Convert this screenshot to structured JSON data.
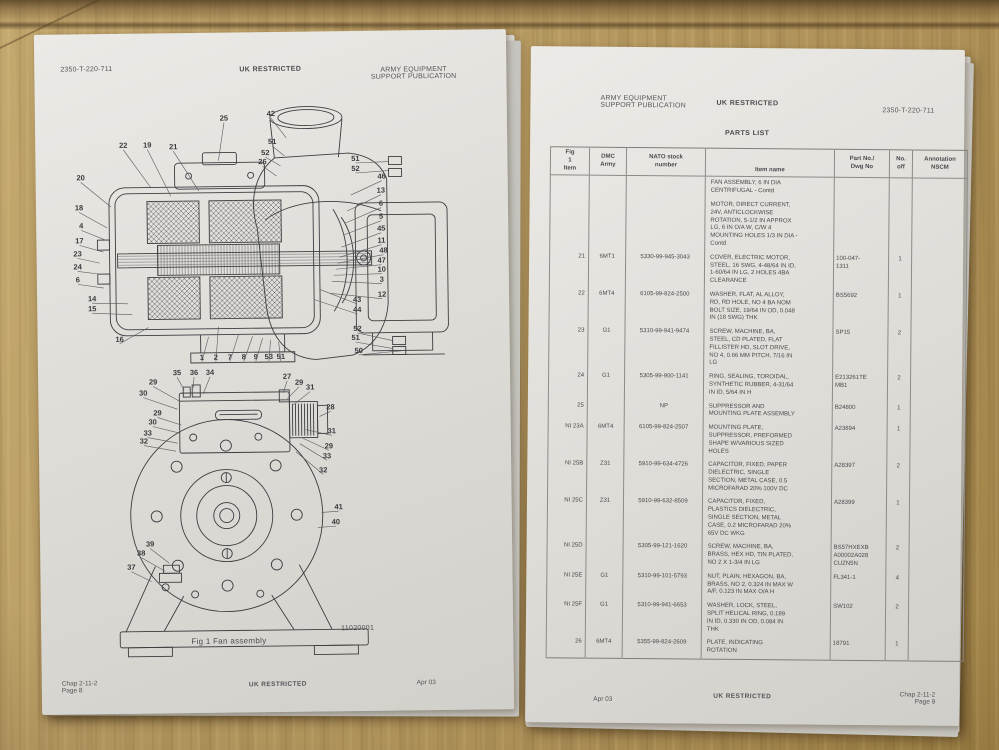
{
  "photo": {
    "wood_color": "#b89c63",
    "paper_color": "#e3e1dc"
  },
  "left_page": {
    "header": {
      "doc_number": "2350-T-220-711",
      "classification": "UK RESTRICTED",
      "publication": "ARMY EQUIPMENT\nSUPPORT PUBLICATION"
    },
    "figure": {
      "caption": "Fig 1  Fan assembly",
      "ref_number": "11020001",
      "top_view_callouts": [
        {
          "label": "22",
          "tx": 73,
          "ty": 46,
          "lx": 100,
          "ly": 86
        },
        {
          "label": "19",
          "tx": 97,
          "ty": 46,
          "lx": 120,
          "ly": 95
        },
        {
          "label": "21",
          "tx": 123,
          "ty": 48,
          "lx": 148,
          "ly": 90
        },
        {
          "label": "20",
          "tx": 30,
          "ty": 78,
          "lx": 60,
          "ly": 105
        },
        {
          "label": "18",
          "tx": 28,
          "ty": 108,
          "lx": 56,
          "ly": 126
        },
        {
          "label": "4",
          "tx": 30,
          "ty": 126,
          "lx": 54,
          "ly": 138
        },
        {
          "label": "17",
          "tx": 28,
          "ty": 141,
          "lx": 52,
          "ly": 150
        },
        {
          "label": "23",
          "tx": 26,
          "ty": 154,
          "lx": 48,
          "ly": 161
        },
        {
          "label": "24",
          "tx": 26,
          "ty": 167,
          "lx": 48,
          "ly": 172
        },
        {
          "label": "6",
          "tx": 26,
          "ty": 180,
          "lx": 52,
          "ly": 186
        },
        {
          "label": "14",
          "tx": 40,
          "ty": 199,
          "lx": 76,
          "ly": 202
        },
        {
          "label": "15",
          "tx": 40,
          "ty": 209,
          "lx": 80,
          "ly": 213
        },
        {
          "label": "16",
          "tx": 67,
          "ty": 240,
          "lx": 96,
          "ly": 226
        },
        {
          "label": "25",
          "tx": 174,
          "ty": 20,
          "lx": 168,
          "ly": 60
        },
        {
          "label": "42",
          "tx": 221,
          "ty": 16,
          "lx": 236,
          "ly": 38
        },
        {
          "label": "51",
          "tx": 222,
          "ty": 44,
          "lx": 234,
          "ly": 56
        },
        {
          "label": "52",
          "tx": 215,
          "ty": 55,
          "lx": 230,
          "ly": 66
        },
        {
          "label": "26",
          "tx": 212,
          "ty": 64,
          "lx": 226,
          "ly": 76
        },
        {
          "label": "51",
          "tx": 305,
          "ty": 62,
          "lx": 338,
          "ly": 63
        },
        {
          "label": "52",
          "tx": 305,
          "ty": 72,
          "lx": 338,
          "ly": 72
        },
        {
          "label": "46",
          "tx": 331,
          "ty": 80,
          "lx": 300,
          "ly": 96
        },
        {
          "label": "13",
          "tx": 330,
          "ty": 94,
          "lx": 296,
          "ly": 112
        },
        {
          "label": "6",
          "tx": 330,
          "ty": 107,
          "lx": 294,
          "ly": 124
        },
        {
          "label": "5",
          "tx": 330,
          "ty": 120,
          "lx": 292,
          "ly": 136
        },
        {
          "label": "45",
          "tx": 330,
          "ty": 132,
          "lx": 290,
          "ly": 148
        },
        {
          "label": "11",
          "tx": 330,
          "ty": 144,
          "lx": 288,
          "ly": 158
        },
        {
          "label": "48",
          "tx": 332,
          "ty": 154,
          "lx": 286,
          "ly": 164
        },
        {
          "label": "47",
          "tx": 330,
          "ty": 164,
          "lx": 284,
          "ly": 170
        },
        {
          "label": "10",
          "tx": 330,
          "ty": 173,
          "lx": 282,
          "ly": 176
        },
        {
          "label": "3",
          "tx": 330,
          "ty": 183,
          "lx": 280,
          "ly": 182
        },
        {
          "label": "12",
          "tx": 330,
          "ty": 198,
          "lx": 278,
          "ly": 194
        },
        {
          "label": "43",
          "tx": 305,
          "ty": 203,
          "lx": 268,
          "ly": 190
        },
        {
          "label": "44",
          "tx": 305,
          "ty": 213,
          "lx": 262,
          "ly": 200
        },
        {
          "label": "52",
          "tx": 305,
          "ty": 232,
          "lx": 340,
          "ly": 242
        },
        {
          "label": "51",
          "tx": 303,
          "ty": 241,
          "lx": 340,
          "ly": 250
        },
        {
          "label": "50",
          "tx": 306,
          "ty": 254,
          "lx": 352,
          "ly": 252
        },
        {
          "label": "1",
          "tx": 149,
          "ty": 259,
          "lx": 156,
          "ly": 236
        },
        {
          "label": "2",
          "tx": 163,
          "ty": 259,
          "lx": 166,
          "ly": 226
        },
        {
          "label": "7",
          "tx": 177,
          "ty": 259,
          "lx": 186,
          "ly": 234
        },
        {
          "label": "8",
          "tx": 191,
          "ty": 259,
          "lx": 200,
          "ly": 236
        },
        {
          "label": "9",
          "tx": 203,
          "ty": 259,
          "lx": 210,
          "ly": 238
        },
        {
          "label": "53",
          "tx": 216,
          "ty": 259,
          "lx": 218,
          "ly": 240
        },
        {
          "label": "51",
          "tx": 228,
          "ty": 259,
          "lx": 226,
          "ly": 242
        }
      ],
      "bottom_view_callouts": [
        {
          "label": "35",
          "tx": 124,
          "ty": 274,
          "lx": 131,
          "ly": 289
        },
        {
          "label": "36",
          "tx": 141,
          "ty": 274,
          "lx": 140,
          "ly": 287
        },
        {
          "label": "34",
          "tx": 157,
          "ty": 274,
          "lx": 150,
          "ly": 293
        },
        {
          "label": "27",
          "tx": 234,
          "ty": 279,
          "lx": 230,
          "ly": 293
        },
        {
          "label": "29",
          "tx": 246,
          "ty": 285,
          "lx": 234,
          "ly": 299
        },
        {
          "label": "31",
          "tx": 257,
          "ty": 290,
          "lx": 240,
          "ly": 305
        },
        {
          "label": "29",
          "tx": 100,
          "ty": 283,
          "lx": 126,
          "ly": 300
        },
        {
          "label": "30",
          "tx": 90,
          "ty": 294,
          "lx": 124,
          "ly": 308
        },
        {
          "label": "29",
          "tx": 104,
          "ty": 314,
          "lx": 128,
          "ly": 324
        },
        {
          "label": "30",
          "tx": 99,
          "ty": 323,
          "lx": 126,
          "ly": 332
        },
        {
          "label": "33",
          "tx": 94,
          "ty": 334,
          "lx": 124,
          "ly": 342
        },
        {
          "label": "32",
          "tx": 90,
          "ty": 342,
          "lx": 122,
          "ly": 350
        },
        {
          "label": "28",
          "tx": 277,
          "ty": 310,
          "lx": 266,
          "ly": 317
        },
        {
          "label": "31",
          "tx": 278,
          "ty": 334,
          "lx": 252,
          "ly": 330
        },
        {
          "label": "29",
          "tx": 275,
          "ty": 349,
          "lx": 248,
          "ly": 338
        },
        {
          "label": "33",
          "tx": 273,
          "ty": 359,
          "lx": 246,
          "ly": 344
        },
        {
          "label": "32",
          "tx": 269,
          "ty": 373,
          "lx": 242,
          "ly": 352
        },
        {
          "label": "41",
          "tx": 284,
          "ty": 410,
          "lx": 267,
          "ly": 413
        },
        {
          "label": "40",
          "tx": 281,
          "ty": 425,
          "lx": 263,
          "ly": 428
        },
        {
          "label": "39",
          "tx": 95,
          "ty": 445,
          "lx": 114,
          "ly": 462
        },
        {
          "label": "38",
          "tx": 86,
          "ty": 454,
          "lx": 110,
          "ly": 470
        },
        {
          "label": "37",
          "tx": 76,
          "ty": 468,
          "lx": 96,
          "ly": 480
        }
      ]
    },
    "footer": {
      "chapter": "Chap 2-11-2",
      "page": "Page 8",
      "classification": "UK RESTRICTED",
      "date": "Apr 03"
    }
  },
  "right_page": {
    "header": {
      "publication": "ARMY EQUIPMENT\nSUPPORT PUBLICATION",
      "classification": "UK RESTRICTED",
      "doc_number": "2350-T-220-711"
    },
    "title": "PARTS LIST",
    "table": {
      "headers": [
        "Fig\n1\nItem",
        "DMC\nArmy",
        "NATO stock\nnumber",
        "Item name",
        "Part No./\nDwg No",
        "No.\noff",
        "Annotation\nNSCM"
      ],
      "rows": [
        {
          "item": "",
          "dmc": "",
          "nato": "",
          "name": "FAN ASSEMBLY, 6 IN DIA\nCENTRIFUGAL - Contd",
          "part": "",
          "qty": "",
          "ann": ""
        },
        {
          "item": "",
          "dmc": "",
          "nato": "",
          "name": "MOTOR, DIRECT CURRENT,\n24V, ANTICLOCKWISE\nROTATION, 5-1/2 IN APPROX\nLG, 6 IN O/A W, C/W 4\nMOUNTING HOLES 1/3 IN DIA -\nContd",
          "part": "",
          "qty": "",
          "ann": ""
        },
        {
          "item": "21",
          "dmc": "6MT1",
          "nato": "5330-99-945-3043",
          "name": "COVER, ELECTRIC MOTOR,\nSTEEL, 16 SWG, 4-48/64 IN ID,\n1-60/64 IN LG, 2 HOLES 4BA\nCLEARANCE",
          "part": "100-047-\n1311",
          "qty": "1",
          "ann": ""
        },
        {
          "item": "22",
          "dmc": "6MT4",
          "nato": "6105-99-824-2500",
          "name": "WASHER, FLAT, AL ALLOY,\nRD, RD HOLE, NO 4 BA NOM\nBOLT SIZE, 19/64 IN OD, 0.048\nIN (18 SWG) THK",
          "part": "BS5692",
          "qty": "1",
          "ann": ""
        },
        {
          "item": "23",
          "dmc": "G1",
          "nato": "5310-99-941-9474",
          "name": "SCREW, MACHINE, BA,\nSTEEL, CD PLATED, FLAT\nFILLISTER HD, SLOT DRIVE,\nNO 4, 0.66 MM PITCH, 7/16 IN\nLG",
          "part": "SP15",
          "qty": "2",
          "ann": ""
        },
        {
          "item": "24",
          "dmc": "G1",
          "nato": "5305-99-900-1141",
          "name": "RING, SEALING, TOROIDAL,\nSYNTHETIC RUBBER, 4-31/64\nIN ID, 5/64 IN H",
          "part": "E213261TE\nMB1",
          "qty": "2",
          "ann": ""
        },
        {
          "item": "25",
          "dmc": "",
          "nato": "NP",
          "name": "SUPPRESSOR AND\nMOUNTING PLATE ASSEMBLY",
          "part": "B24800",
          "qty": "1",
          "ann": ""
        },
        {
          "item": "NI 23A",
          "dmc": "6MT4",
          "nato": "6105-99-824-2507",
          "name": "MOUNTING PLATE,\nSUPPRESSOR, PREFORMED\nSHAPE W/VARIOUS SIZED\nHOLES",
          "part": "A23894",
          "qty": "1",
          "ann": ""
        },
        {
          "item": "NI 25B",
          "dmc": "Z31",
          "nato": "5910-99-634-4726",
          "name": "CAPACITOR, FIXED, PAPER\nDIELECTRIC, SINGLE\nSECTION, METAL CASE, 0.5\nMICROFARAD 20% 100V DC",
          "part": "A28397",
          "qty": "2",
          "ann": ""
        },
        {
          "item": "NI 25C",
          "dmc": "Z31",
          "nato": "5910-99-632-8509",
          "name": "CAPACITOR, FIXED,\nPLASTICS DIELECTRIC,\nSINGLE SECTION, METAL\nCASE, 0.2 MICROFARAD 20%\n65V DC WKG",
          "part": "A28399",
          "qty": "1",
          "ann": ""
        },
        {
          "item": "NI 25D",
          "dmc": "",
          "nato": "5305-99-121-1620",
          "name": "SCREW, MACHINE, BA,\nBRASS, HEX HD, TIN PLATED,\nNO 2 X 1-3/4 IN LG",
          "part": "BS57HXEXB\nA00002A028\nCUZN5N",
          "qty": "2",
          "ann": ""
        },
        {
          "item": "NI 25E",
          "dmc": "G1",
          "nato": "5310-99-101-5793",
          "name": "NUT, PLAIN, HEXAGON, BA,\nBRASS, NO 2, 0.324 IN MAX W\nA/F, 0.123 IN MAX O/A H",
          "part": "FL341-1",
          "qty": "4",
          "ann": ""
        },
        {
          "item": "NI 25F",
          "dmc": "G1",
          "nato": "5310-99-941-6653",
          "name": "WASHER, LOCK, STEEL,\nSPLIT HELICAL RING, 0.189\nIN ID, 0.330 IN OD, 0.084 IN\nTHK",
          "part": "SW102",
          "qty": "2",
          "ann": ""
        },
        {
          "item": "26",
          "dmc": "6MT4",
          "nato": "5355-99-824-2609",
          "name": "PLATE, INDICATING\nROTATION",
          "part": "18791",
          "qty": "1",
          "ann": ""
        }
      ]
    },
    "footer": {
      "date": "Apr 03",
      "classification": "UK RESTRICTED",
      "chapter": "Chap 2-11-2",
      "page": "Page 9"
    }
  }
}
